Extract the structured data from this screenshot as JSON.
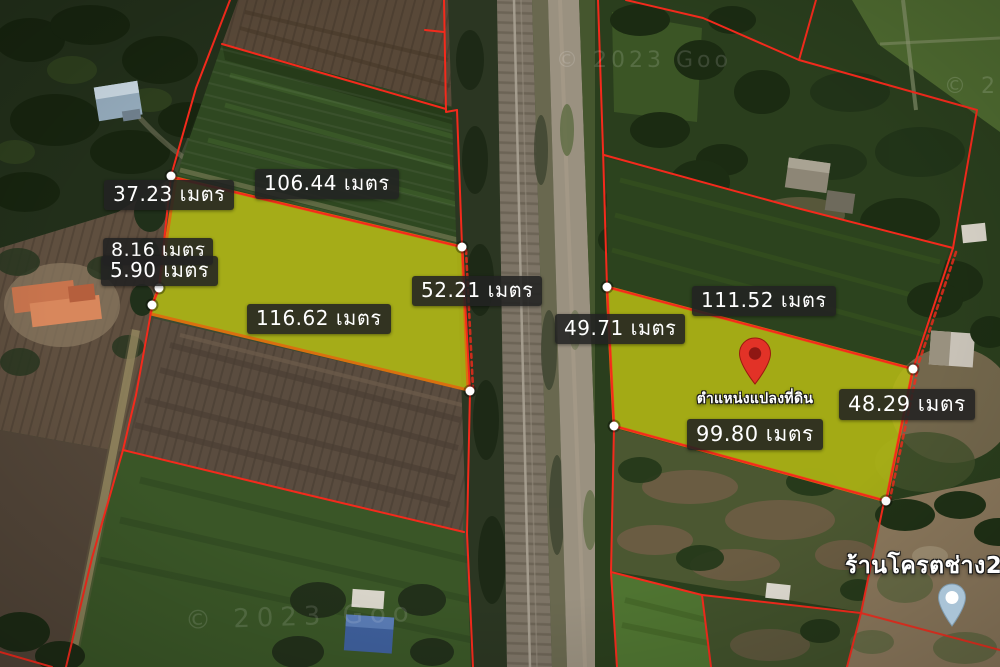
{
  "map": {
    "type": "satellite-land-plot-annotation",
    "watermarks": [
      {
        "text": "© 2023 Goo"
      },
      {
        "text": "© 2023 Goo"
      },
      {
        "text": "© 2"
      }
    ]
  },
  "measurements": [
    {
      "id": "left-plot-west-upper",
      "text": "37.23 เมตร"
    },
    {
      "id": "left-plot-north",
      "text": "106.44 เมตร"
    },
    {
      "id": "left-plot-west-mid",
      "text": "8.16 เมตร"
    },
    {
      "id": "left-plot-west-lower",
      "text": "5.90 เมตร"
    },
    {
      "id": "left-plot-east",
      "text": "52.21 เมตร"
    },
    {
      "id": "left-plot-south",
      "text": "116.62 เมตร"
    },
    {
      "id": "right-plot-west",
      "text": "49.71 เมตร"
    },
    {
      "id": "right-plot-north",
      "text": "111.52 เมตร"
    },
    {
      "id": "right-plot-east",
      "text": "48.29 เมตร"
    },
    {
      "id": "right-plot-south",
      "text": "99.80 เมตร"
    }
  ],
  "markers": {
    "land_plot_pin_label": "ตำแหน่งแปลงที่ดิน",
    "poi_label": "ร้านโครตช่าง2"
  },
  "colors": {
    "plot_highlight": "#b4b915",
    "plot_border": "#d9700f",
    "boundary_line": "#f42a1c",
    "label_bg": "#262626",
    "label_text": "#ffffff",
    "pin_red": "#e23227",
    "pin_poi": "#aac4d7"
  }
}
